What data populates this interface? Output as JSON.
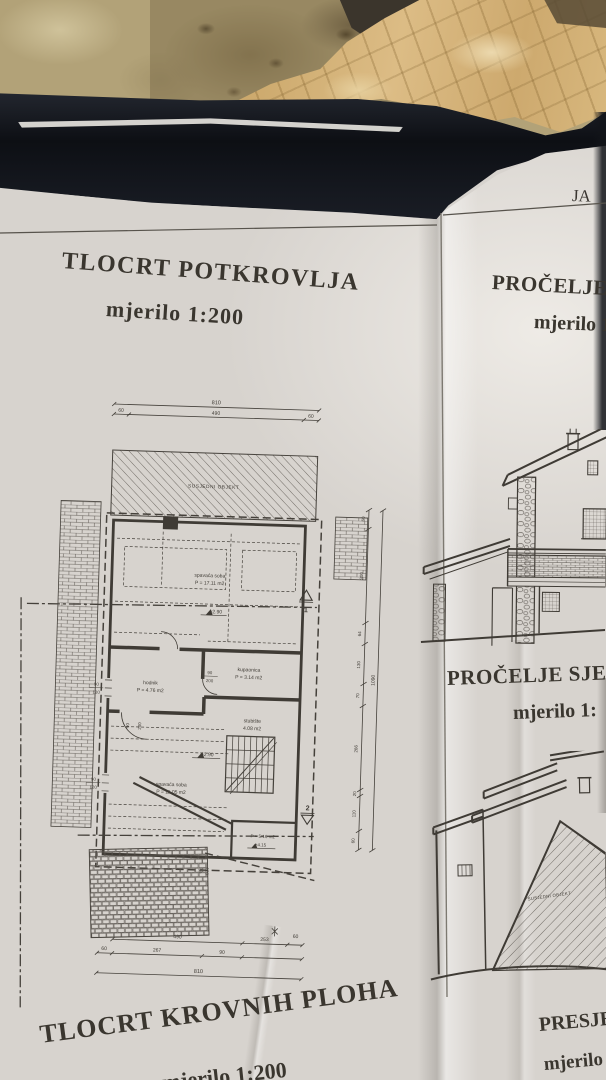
{
  "colors": {
    "paper": "#d7d3ce",
    "ink": "#3f3b35",
    "folder": "#14161b",
    "stone": "#b2a278",
    "crumpled_paper": "#d4b277"
  },
  "photo": {
    "sheet_edge_fragment": "JA"
  },
  "panels": {
    "attic_plan": {
      "title": "TLOCRT POTKROVLJA",
      "scale": "mjerilo 1:200"
    },
    "facade_south": {
      "title": "PROČELJE JU",
      "scale": "mjerilo 1"
    },
    "facade_north": {
      "title": "PROČELJE SJEVE",
      "scale": "mjerilo 1:"
    },
    "roof_plan": {
      "title": "TLOCRT KROVNIH PLOHA",
      "scale": "mjerilo 1:200"
    },
    "section": {
      "title": "PRESJE",
      "scale": "mjerilo"
    }
  },
  "plan": {
    "neighbor_label": "SUSJEDNI OBJEKT",
    "rooms": {
      "bedroom1": {
        "name": "spavaća soba",
        "area": "P = 17.11 m2",
        "level": "+2.90"
      },
      "hall": {
        "name": "hodnik",
        "area": "P = 4.76 m2"
      },
      "bath": {
        "name": "kupaonica",
        "area": "P = 3.14 m2"
      },
      "stairs": {
        "name": "stubište",
        "area": "4.08 m2"
      },
      "bedroom2": {
        "name": "spavaća soba",
        "area": "P = 11.05 m2",
        "level": "+2.90"
      },
      "small_room": {
        "area": "P = 5.16 m2",
        "level": "+4.15"
      }
    },
    "openings": {
      "door_w": "90",
      "door_h": "200",
      "win_w": "90",
      "win_h": "120"
    },
    "dims": {
      "top_total": "810",
      "top_segments": [
        "60",
        "490",
        "60"
      ],
      "bottom_row1": [
        "490",
        "253",
        "60"
      ],
      "bottom_row2": [
        "60",
        "267",
        "90"
      ],
      "bottom_total": "810",
      "right_segments": [
        "60",
        "300",
        "64",
        "130",
        "70",
        "266",
        "20",
        "110",
        "60"
      ],
      "right_total": "1090"
    },
    "section_markers": {
      "m1": "1",
      "m2": "2"
    }
  },
  "elevation_north": {
    "neighbor_label": "SUSJEDNI OBJEKT"
  }
}
